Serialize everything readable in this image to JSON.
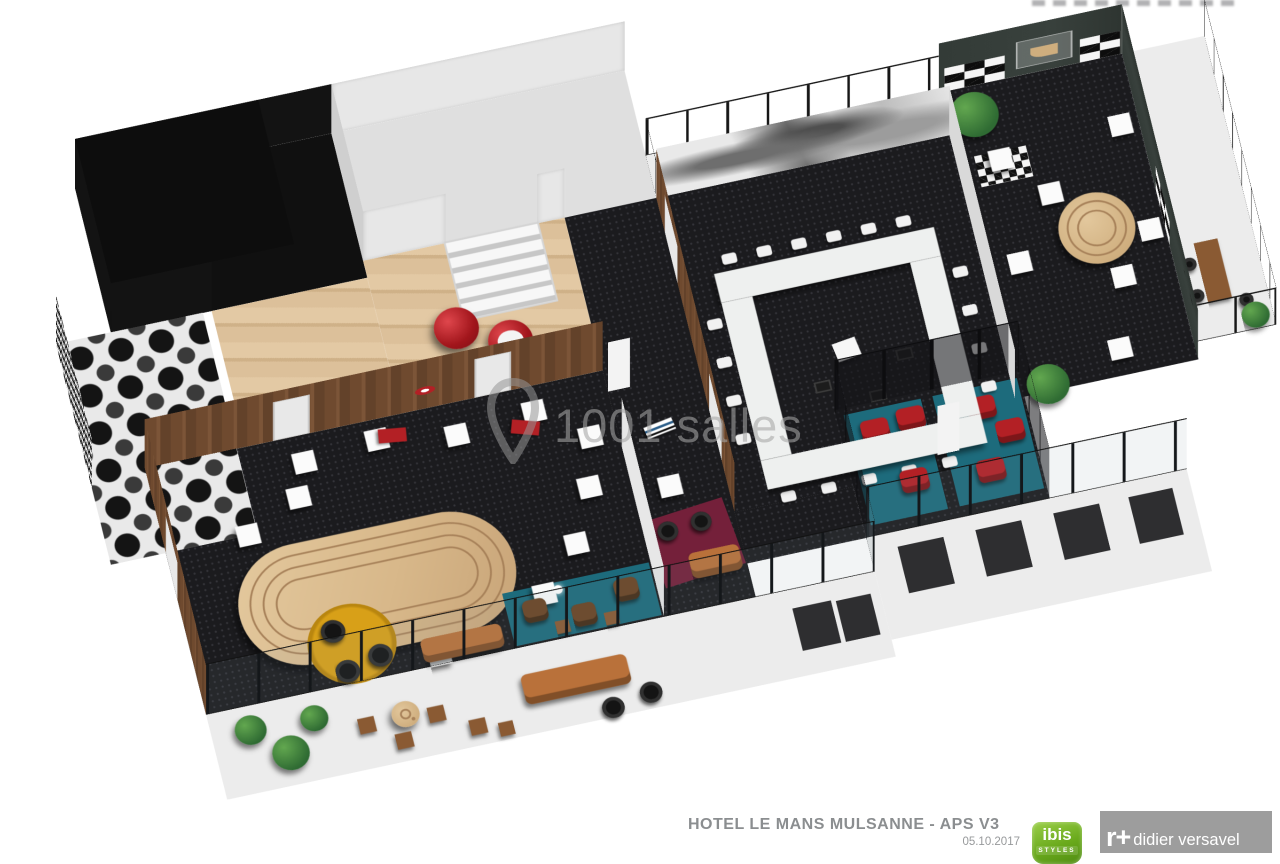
{
  "watermark": {
    "text": "1001 salles"
  },
  "footer": {
    "title": "HOTEL LE MANS MULSANNE - APS V3",
    "date": "05.10.2017"
  },
  "logos": {
    "ibis": {
      "name": "ibis",
      "subtitle": "STYLES"
    },
    "architect": {
      "mark": "r+",
      "name": "didier versavel"
    }
  },
  "colors": {
    "dark_floor": "#1b1b1e",
    "wood_wall": "#6f4a2f",
    "light_wood_floor": "#dcc09a",
    "oval_wood": "#d8b88a",
    "teal": "#1d6b7c",
    "red_accent": "#b32025",
    "maroon_rug": "#74203a",
    "yellow_rug": "#d8a018",
    "tan_leather": "#b9713a",
    "slate_wall": "#39413d",
    "ibis_green": "#6aaa1c",
    "architect_gray": "#9d9d9d",
    "title_gray": "#8b8e90",
    "watermark_gray": "#a5a5a5"
  }
}
